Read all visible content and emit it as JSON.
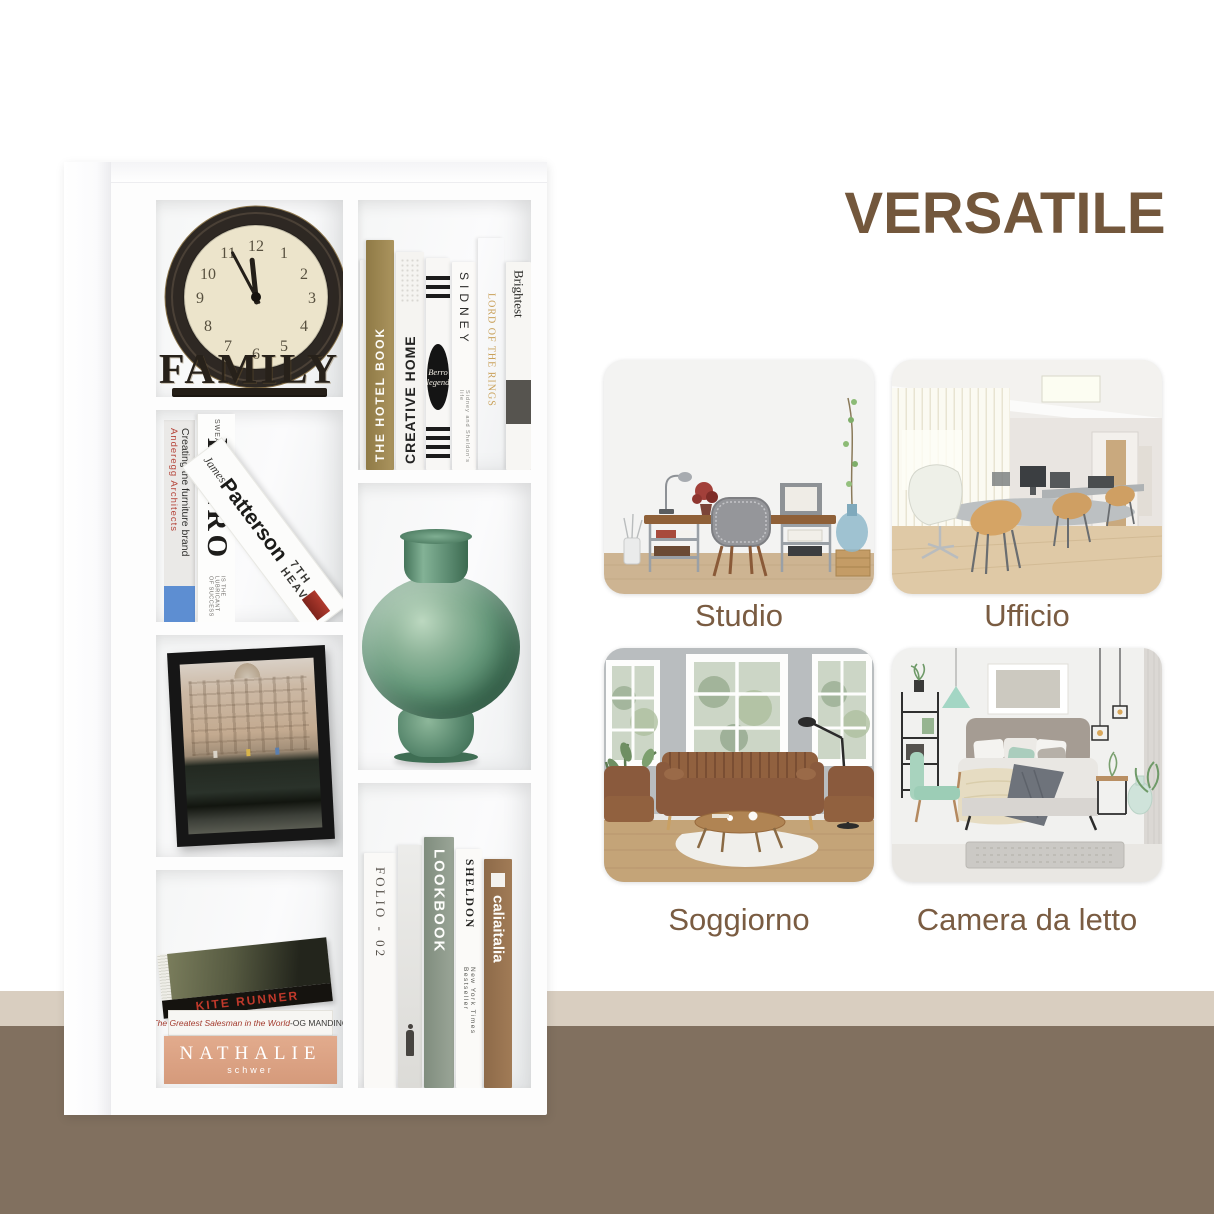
{
  "title": {
    "text": "VERSATILE",
    "color": "#73573C"
  },
  "backdrop": {
    "beige_band": "#D9CEC0",
    "brown_band": "#81705F"
  },
  "rooms": [
    {
      "label": "Studio"
    },
    {
      "label": "Ufficio"
    },
    {
      "label": "Soggiorno"
    },
    {
      "label": "Camera da letto"
    }
  ],
  "clock": {
    "base_word": "FAMILY",
    "numerals": [
      "12",
      "1",
      "2",
      "3",
      "4",
      "5",
      "6",
      "7",
      "8",
      "9",
      "10",
      "11"
    ]
  },
  "books": {
    "anderegg": {
      "line1": "Anderegg Architects",
      "line2": "Creating the furniture brand"
    },
    "evero": {
      "top": "SWEAT",
      "title": "EVERO",
      "subtitle": "IS THE LUBRICANT OF SUCCESS"
    },
    "patterson": {
      "author": "James",
      "surname": "Patterson",
      "title": "7TH HEAVEN"
    },
    "hotel": {
      "title": "THE HOTEL BOOK"
    },
    "creative": {
      "title": "CREATIVE HOME"
    },
    "berro": {
      "line1": "Berro",
      "line2": "legend"
    },
    "sidney": {
      "title": "SIDNEY",
      "subtitle": "Sidney and Sheldon's life"
    },
    "lotr": {
      "title": "LORD OF THE RINGS"
    },
    "brightest": {
      "title": "Brightest"
    },
    "kite": {
      "title": "KITE RUNNER"
    },
    "salesman": {
      "title": "The Greatest Salesman in the World",
      "author": " -OG MANDINO"
    },
    "nathalie": {
      "title": "NATHALIE",
      "subtitle": "schwer"
    },
    "folio": {
      "title": "FOLIO - 02"
    },
    "lookbook": {
      "title": "LOOKBOOK"
    },
    "sheldon": {
      "title": "SHELDON",
      "subtitle": "New York Times Bestseller"
    },
    "calia": {
      "title": "caliaitalia"
    }
  }
}
